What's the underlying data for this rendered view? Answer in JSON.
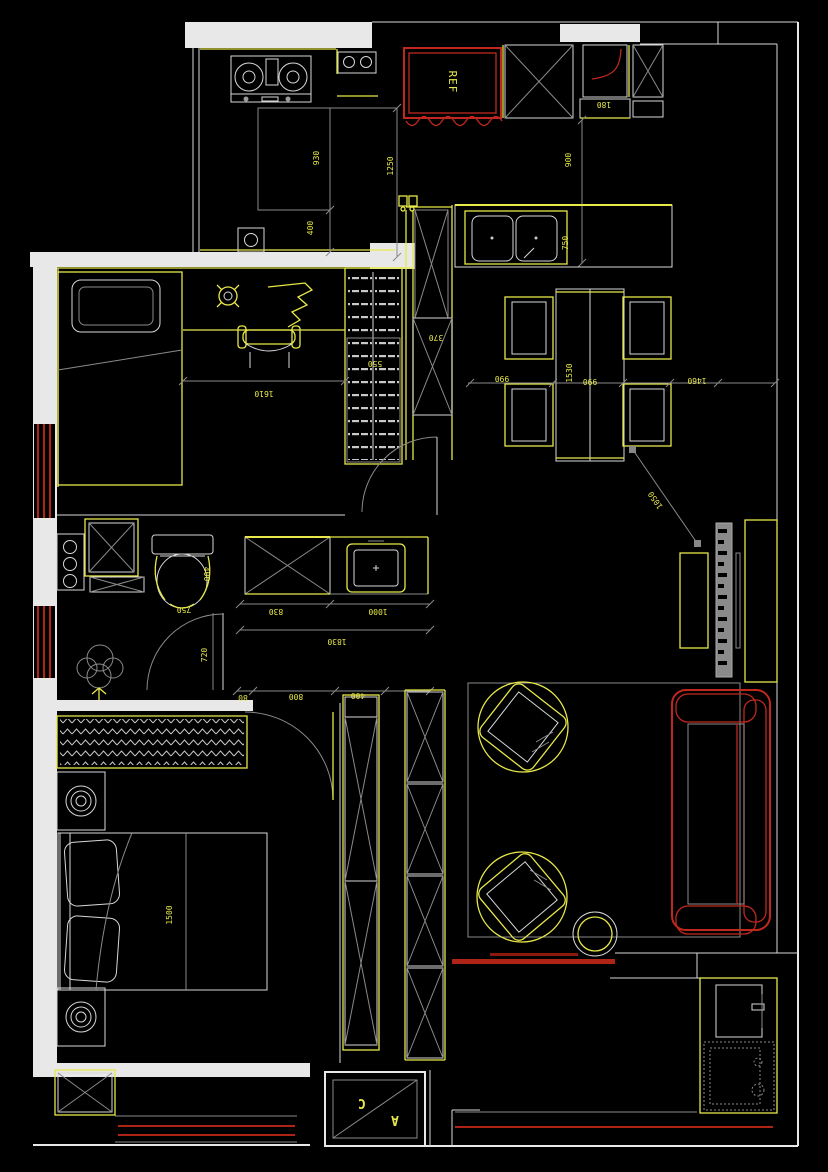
{
  "drawing": {
    "type": "apartment-floor-plan",
    "appliance_labels": {
      "refrigerator": "REF"
    },
    "section_marker": {
      "letter_top": "C",
      "letter_bottom": "A"
    },
    "dimensions": {
      "kitchen_island_depth": "930",
      "kitchen_run": "1250",
      "kitchen_clearance": "400",
      "top_column_gap": "180",
      "fridge_wall_run": "900",
      "counter_depth": "750",
      "dining_left_clearance": "990",
      "dining_table_length": "1530",
      "dining_table_width": "990",
      "dining_right_clearance": "1460",
      "tv_diagonal_clearance": "1050",
      "bedroom2_bed_length": "1610",
      "wardrobe_depth": "550",
      "cabinet_depth": "370",
      "toilet_width": "400",
      "toilet_clearance": "750",
      "bath_door_width": "720",
      "vanity_width": "830",
      "basin_counter_width": "1000",
      "bath_wall_total": "1830",
      "bedroom1_dim_a": "80",
      "bedroom1_door_width": "800",
      "bedroom1_dim_b": "400",
      "bed_width": "1500"
    },
    "colors": {
      "background": "#000000",
      "wall": "#e8e8e8",
      "furniture_yellow": "#e8e84a",
      "accent_red": "#c0281e",
      "dim_text": "#e8e84a"
    }
  }
}
